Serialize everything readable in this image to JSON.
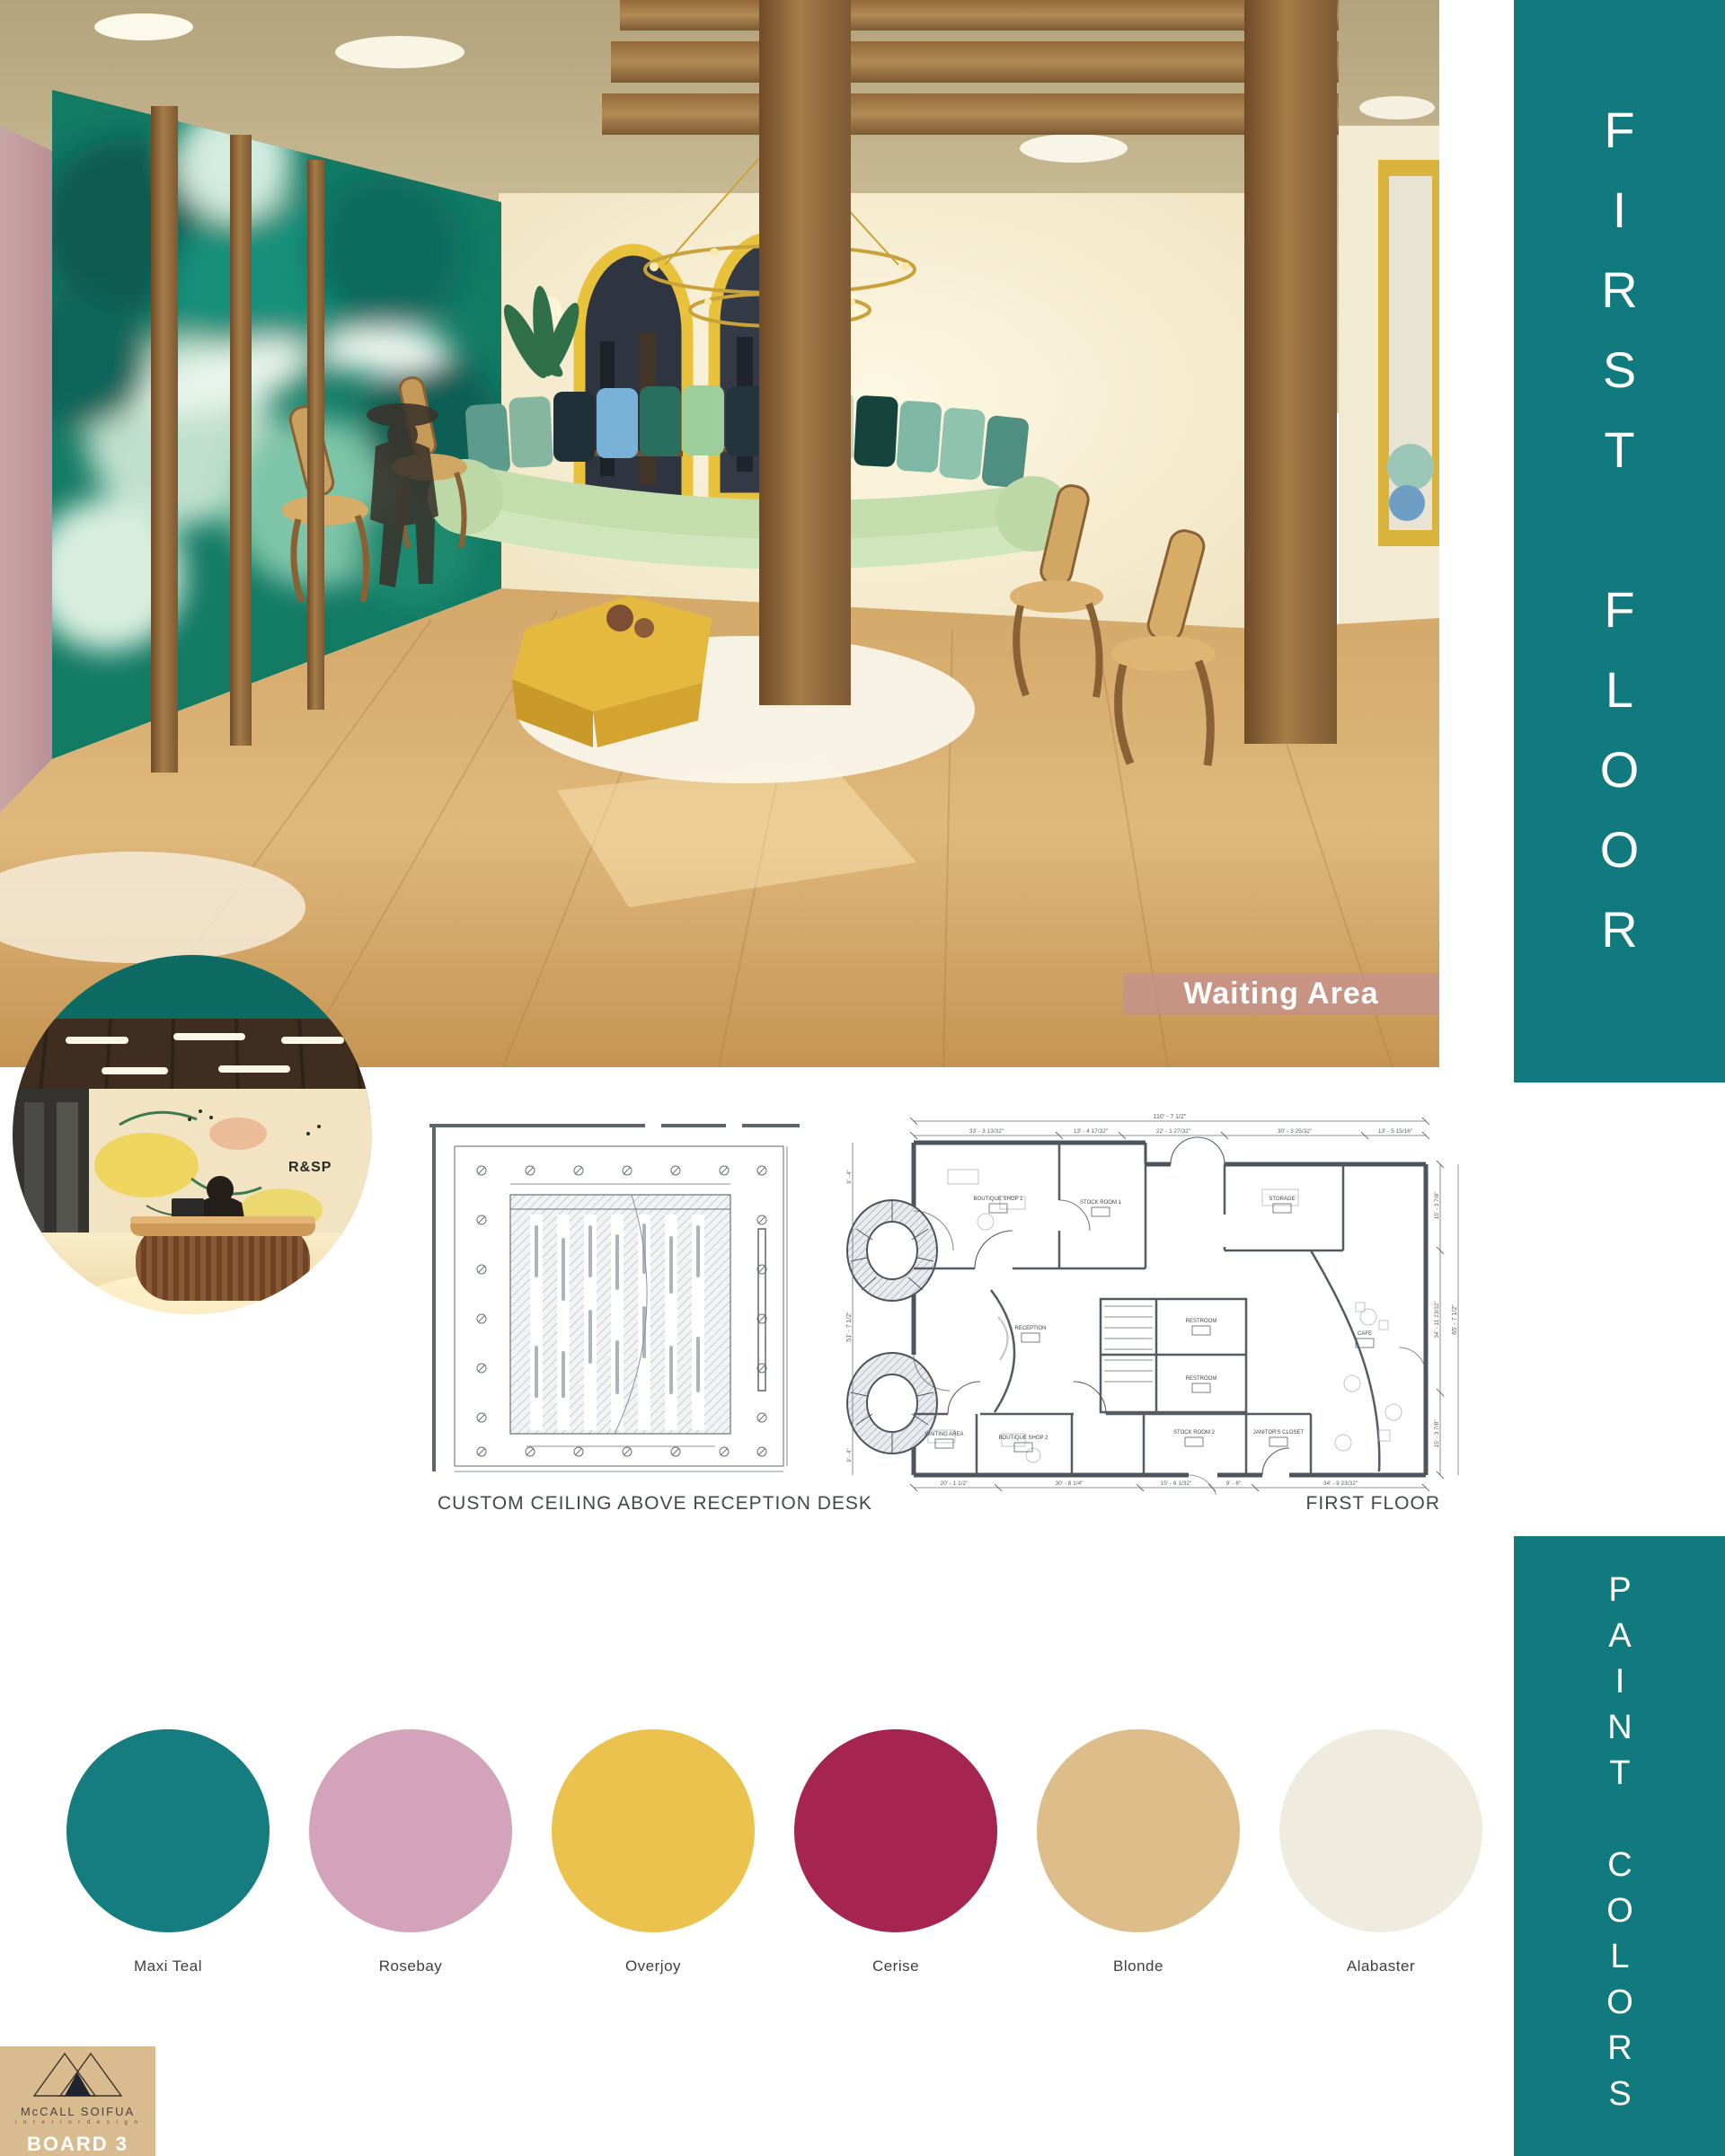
{
  "banners": {
    "first_floor": "FIRST FLOOR",
    "paint_colors": "PAINT COLORS",
    "teal": "#117a7e"
  },
  "rendering": {
    "caption": "Waiting Area"
  },
  "inset": {
    "wall_logo": "R&SP"
  },
  "drawings": {
    "ceiling_caption": "CUSTOM CEILING ABOVE RECEPTION DESK",
    "plan_caption": "FIRST FLOOR",
    "plan": {
      "top_overall": "110' - 7 1/2\"",
      "top_segments": [
        "33' - 3 13/32\"",
        "13' - 4 17/32\"",
        "22' - 1 27/32\"",
        "30' - 3 25/32\"",
        "13' - 5 15/16\""
      ],
      "bottom_segments": [
        "20' - 1 1/2\"",
        "30' - 8 1/4\"",
        "15' - 6 1/32\"",
        "9' - 6\"",
        "34' - 9 23/32\""
      ],
      "right_segments": [
        "15' - 3 7/8\"",
        "34' - 11 23/32\"",
        "15' - 3 7/8\""
      ],
      "right_overall": "65' - 7 1/2\"",
      "left_overall": "51' - 7 1/2\"",
      "left_top_small": "9' - 4\"",
      "left_bottom_small": "9' - 4\"",
      "rooms": [
        "BOUTIQUE SHOP 1",
        "STOCK ROOM 1",
        "STORAGE",
        "RECEPTION",
        "RESTROOM",
        "RESTROOM",
        "CAFE",
        "WAITING AREA",
        "BOUTIQUE SHOP 2",
        "STOCK ROOM 2",
        "JANITOR'S CLOSET"
      ]
    }
  },
  "palette": {
    "swatches": [
      {
        "name": "Maxi Teal",
        "color": "#157d80"
      },
      {
        "name": "Rosebay",
        "color": "#d3a3bc"
      },
      {
        "name": "Overjoy",
        "color": "#ecc24f"
      },
      {
        "name": "Cerise",
        "color": "#a62450"
      },
      {
        "name": "Blonde",
        "color": "#ddbe8b"
      },
      {
        "name": "Alabaster",
        "color": "#efecdf"
      }
    ]
  },
  "logo": {
    "name": "McCALL SOIFUA",
    "subtitle": "i n t e r i o r   d e s i g n",
    "board": "BOARD 3"
  }
}
